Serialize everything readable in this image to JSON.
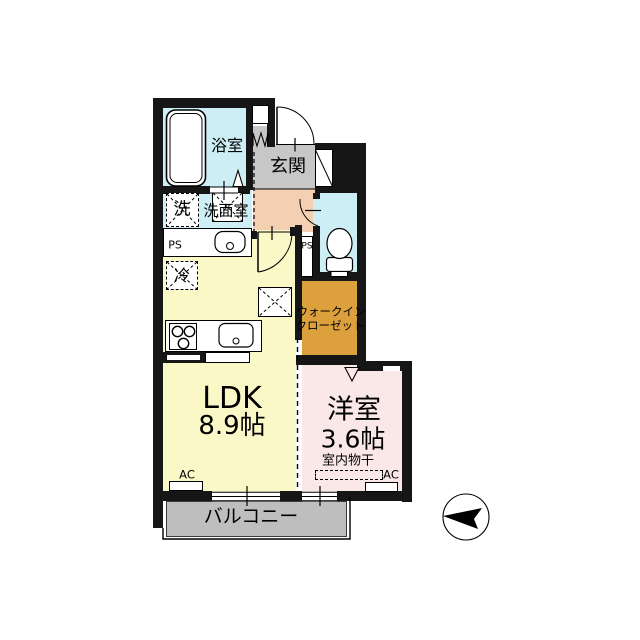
{
  "floorplan": {
    "rooms": {
      "bath": {
        "label": "浴室",
        "color": "#cdeef5"
      },
      "washroom": {
        "label": "洗面室",
        "color": "#cdeef5"
      },
      "washer": {
        "label": "洗"
      },
      "entrance": {
        "label": "玄関",
        "color": "#c7c7c7"
      },
      "hallway": {
        "color": "#f5cfb2"
      },
      "toilet": {
        "color": "#cdeef5"
      },
      "fridge": {
        "label": "冷"
      },
      "ldk": {
        "label": "LDK",
        "size": "8.9帖",
        "color": "#faf8c7"
      },
      "wic": {
        "label_line1": "ウォークイン",
        "label_line2": "クローゼット",
        "color": "#dca03d"
      },
      "western": {
        "label": "洋室",
        "size": "3.6帖",
        "color": "#fae8e9"
      },
      "balcony": {
        "label": "バルコニー",
        "color": "#bebebe"
      }
    },
    "labels": {
      "ps_left": "PS",
      "ps_right": "PS",
      "ac_ldk": "AC",
      "ac_western": "AC",
      "indoor_drying": "室内物干"
    },
    "colors": {
      "wall": "#161616"
    },
    "icons": {
      "compass": "north-arrow"
    }
  }
}
